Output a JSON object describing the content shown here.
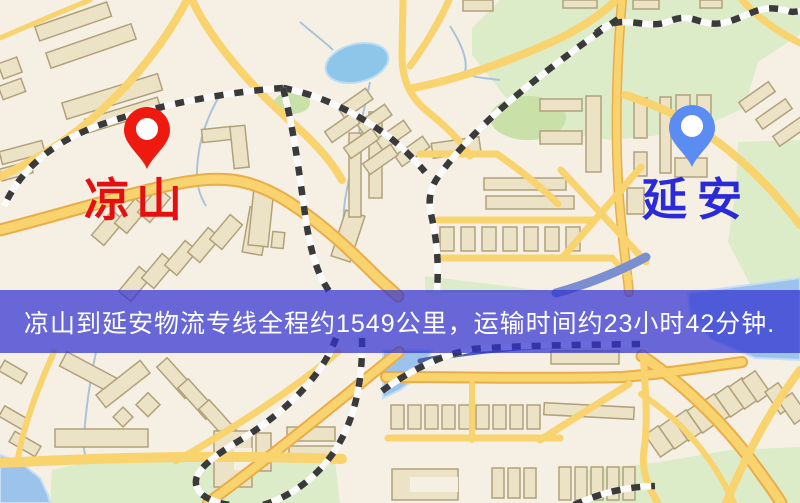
{
  "banner": {
    "text": "凉山到延安物流专线全程约1549公里，运输时间约23小时42分钟.",
    "background_color": "rgba(50,50,209,0.72)",
    "text_color": "#ffffff"
  },
  "route": {
    "origin": "凉山",
    "destination": "延安",
    "distance_text": "约1549公里",
    "duration_text": "约23小时42分钟"
  },
  "markers": {
    "origin": {
      "label": "凉山",
      "pin_color": "#ee1a10",
      "label_color": "#e60f0f",
      "pin_icon": "map-pin"
    },
    "destination": {
      "label": "延安",
      "pin_color": "#5a8cf2",
      "label_color": "#2a2ad8",
      "pin_icon": "map-pin"
    }
  },
  "map": {
    "colors": {
      "background": "#f6f0e4",
      "road": "#f8d36e",
      "road_casing": "#e9ad4a",
      "building_fill": "#ece3c6",
      "building_stroke": "#b1a17b",
      "green_area": "#dcebc8",
      "water": "#9cc3ec",
      "railway_dash": "#3a3a3a"
    }
  }
}
